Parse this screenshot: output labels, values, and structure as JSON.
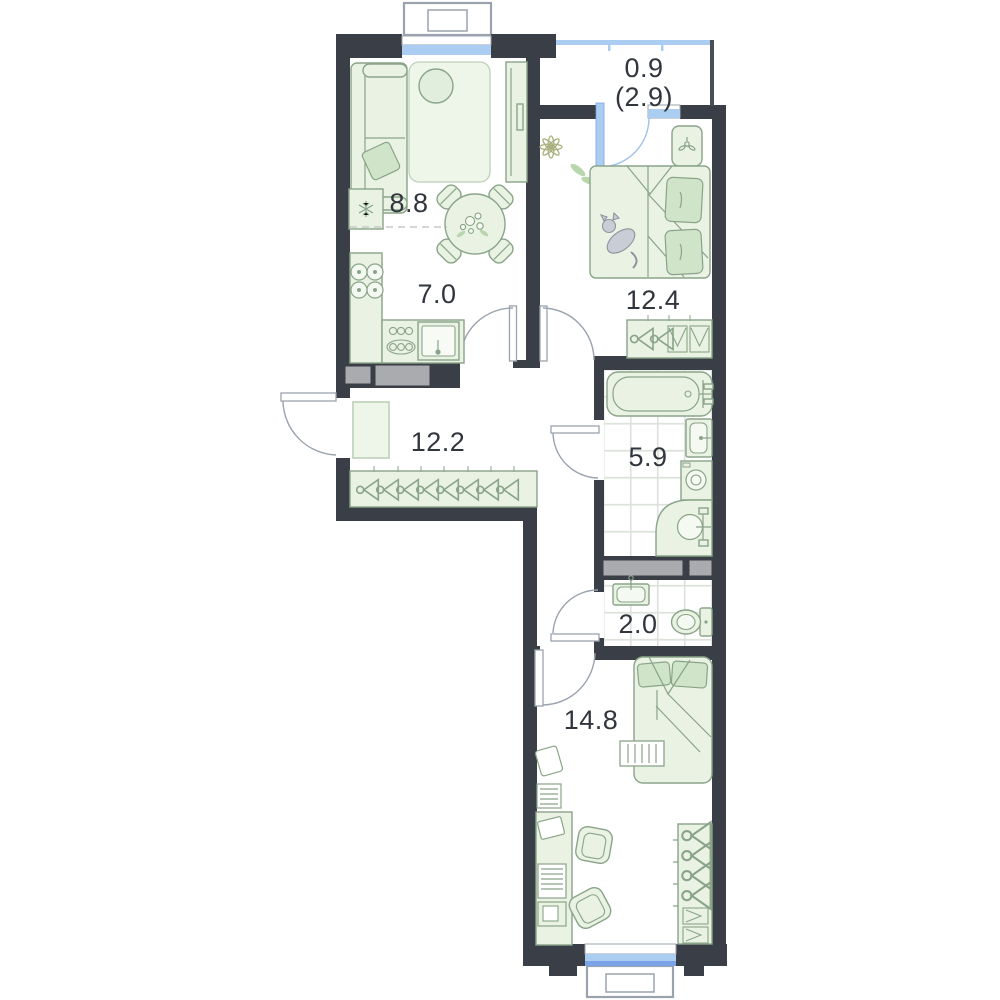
{
  "plan_title": "apartment-floor-plan",
  "rooms": {
    "living": {
      "name": "living-room",
      "area": "8.8"
    },
    "kitchen": {
      "name": "kitchen",
      "area": "7.0"
    },
    "bedroom": {
      "name": "bedroom",
      "area": "12.4"
    },
    "hallway": {
      "name": "hallway",
      "area": "12.2"
    },
    "bathroom": {
      "name": "bathroom",
      "area": "5.9"
    },
    "wc": {
      "name": "wc",
      "area": "2.0"
    },
    "bedroom2": {
      "name": "bedroom-2",
      "area": "14.8"
    },
    "balcony": {
      "name": "balcony",
      "area": "0.9",
      "area_secondary": "(2.9)"
    }
  },
  "colors": {
    "wall": "#3a3e46",
    "furniture_fill": "#e9f2e3",
    "furniture_stroke": "#8aa489",
    "accent_fill": "#cfe4c8",
    "window_blue": "#abcdf1",
    "window_blue_deep": "#7ba3e8",
    "shaft_gray": "#aaabaf",
    "tile_line": "#dde3dc",
    "label_text": "#31363d"
  }
}
